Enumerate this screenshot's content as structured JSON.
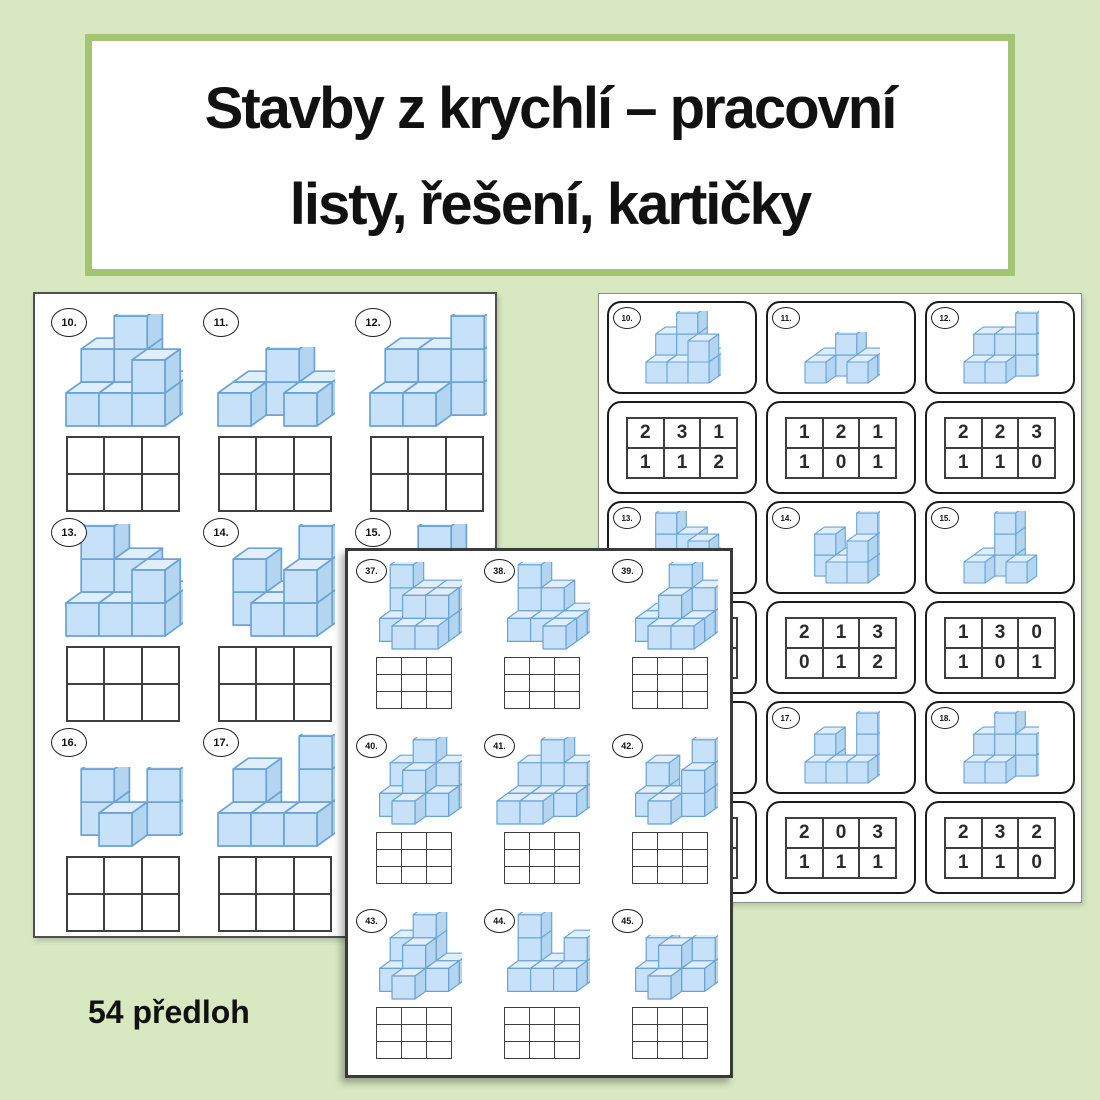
{
  "title": {
    "line1": "Stavby z krychlí – pracovní",
    "line2": "listy, řešení, kartičky"
  },
  "footer": {
    "label": "54 předloh"
  },
  "colors": {
    "background": "#d8e9c2",
    "banner_border": "#a3c573",
    "cube_front": "#c7e2f8",
    "cube_top": "#e1effc",
    "cube_side": "#b3d5f0",
    "cube_edge": "#69a3d8",
    "grid_line": "#3f3f3f",
    "number_color": "#2a2a2a"
  },
  "left_worksheet": {
    "grid": {
      "cols": 3,
      "rows": 2
    },
    "items": [
      {
        "label": "10.",
        "heights": [
          [
            2,
            3,
            1
          ],
          [
            1,
            1,
            2
          ]
        ]
      },
      {
        "label": "11.",
        "heights": [
          [
            1,
            2,
            1
          ],
          [
            1,
            0,
            1
          ]
        ]
      },
      {
        "label": "12.",
        "heights": [
          [
            2,
            2,
            3
          ],
          [
            1,
            1,
            0
          ]
        ]
      },
      {
        "label": "13.",
        "heights": [
          [
            3,
            2,
            1
          ],
          [
            1,
            1,
            2
          ]
        ]
      },
      {
        "label": "14.",
        "heights": [
          [
            2,
            1,
            3
          ],
          [
            0,
            1,
            2
          ]
        ]
      },
      {
        "label": "15.",
        "heights": [
          [
            1,
            3,
            0
          ],
          [
            1,
            0,
            1
          ]
        ]
      },
      {
        "label": "16.",
        "heights": [
          [
            2,
            0,
            2
          ],
          [
            0,
            1,
            0
          ]
        ]
      },
      {
        "label": "17.",
        "heights": [
          [
            2,
            0,
            3
          ],
          [
            1,
            1,
            1
          ]
        ]
      }
    ]
  },
  "front_worksheet": {
    "grid": {
      "cols": 3,
      "rows": 3
    },
    "items": [
      {
        "label": "37.",
        "heights": [
          [
            3,
            2,
            2
          ],
          [
            1,
            2,
            2
          ],
          [
            0,
            1,
            1
          ]
        ]
      },
      {
        "label": "38.",
        "heights": [
          [
            3,
            2,
            1
          ],
          [
            1,
            1,
            1
          ],
          [
            0,
            0,
            1
          ]
        ]
      },
      {
        "label": "39.",
        "heights": [
          [
            1,
            3,
            2
          ],
          [
            1,
            2,
            1
          ],
          [
            0,
            1,
            1
          ]
        ]
      },
      {
        "label": "40.",
        "heights": [
          [
            2,
            3,
            2
          ],
          [
            1,
            2,
            1
          ],
          [
            0,
            1,
            0
          ]
        ]
      },
      {
        "label": "41.",
        "heights": [
          [
            2,
            3,
            2
          ],
          [
            1,
            1,
            1
          ],
          [
            1,
            1,
            0
          ]
        ]
      },
      {
        "label": "42.",
        "heights": [
          [
            2,
            0,
            3
          ],
          [
            1,
            1,
            2
          ],
          [
            0,
            1,
            0
          ]
        ]
      },
      {
        "label": "43.",
        "heights": [
          [
            2,
            3,
            1
          ],
          [
            1,
            2,
            1
          ],
          [
            0,
            1,
            0
          ]
        ]
      },
      {
        "label": "44.",
        "heights": [
          [
            3,
            1,
            2
          ],
          [
            1,
            1,
            1
          ],
          [
            0,
            0,
            0
          ]
        ]
      },
      {
        "label": "45.",
        "heights": [
          [
            2,
            1,
            2
          ],
          [
            1,
            2,
            1
          ],
          [
            0,
            1,
            0
          ]
        ]
      }
    ]
  },
  "cards_page": {
    "cards": [
      {
        "label": "10.",
        "heights": [
          [
            2,
            3,
            1
          ],
          [
            1,
            1,
            2
          ]
        ],
        "answer": [
          [
            2,
            3,
            1
          ],
          [
            1,
            1,
            2
          ]
        ]
      },
      {
        "label": "11.",
        "heights": [
          [
            1,
            2,
            1
          ],
          [
            1,
            0,
            1
          ]
        ],
        "answer": [
          [
            1,
            2,
            1
          ],
          [
            1,
            0,
            1
          ]
        ]
      },
      {
        "label": "12.",
        "heights": [
          [
            2,
            2,
            3
          ],
          [
            1,
            1,
            0
          ]
        ],
        "answer": [
          [
            2,
            2,
            3
          ],
          [
            1,
            1,
            0
          ]
        ]
      },
      {
        "label": "13.",
        "heights": [
          [
            3,
            2,
            1
          ],
          [
            1,
            1,
            2
          ]
        ],
        "answer": [
          [
            3,
            2,
            1
          ],
          [
            1,
            1,
            2
          ]
        ]
      },
      {
        "label": "14.",
        "heights": [
          [
            2,
            1,
            3
          ],
          [
            0,
            1,
            2
          ]
        ],
        "answer": [
          [
            2,
            1,
            3
          ],
          [
            0,
            1,
            2
          ]
        ]
      },
      {
        "label": "15.",
        "heights": [
          [
            1,
            3,
            0
          ],
          [
            1,
            0,
            1
          ]
        ],
        "answer": [
          [
            1,
            3,
            0
          ],
          [
            1,
            0,
            1
          ]
        ]
      },
      {
        "label": "16.",
        "heights": [
          [
            2,
            0,
            2
          ],
          [
            0,
            1,
            0
          ]
        ],
        "answer": [
          [
            2,
            0,
            2
          ],
          [
            0,
            1,
            0
          ]
        ]
      },
      {
        "label": "17.",
        "heights": [
          [
            2,
            0,
            3
          ],
          [
            1,
            1,
            1
          ]
        ],
        "answer": [
          [
            2,
            0,
            3
          ],
          [
            1,
            1,
            1
          ]
        ]
      },
      {
        "label": "18.",
        "heights": [
          [
            2,
            3,
            2
          ],
          [
            1,
            1,
            0
          ]
        ],
        "answer": [
          [
            2,
            3,
            2
          ],
          [
            1,
            1,
            0
          ]
        ]
      }
    ]
  }
}
